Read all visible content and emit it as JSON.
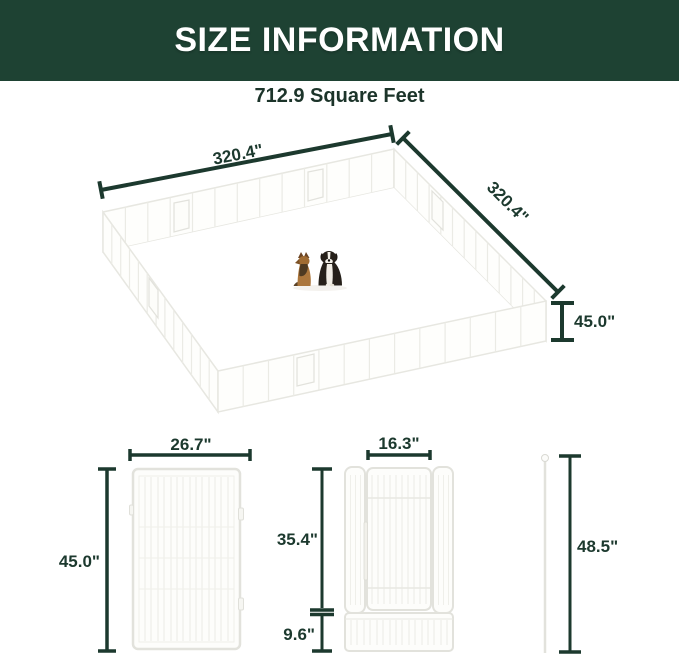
{
  "banner": {
    "title": "SIZE INFORMATION"
  },
  "area": {
    "label": "712.9 Square Feet"
  },
  "enclosure": {
    "width_label": "320.4\"",
    "depth_label": "320.4\"",
    "height_label": "45.0\""
  },
  "panel": {
    "width_label": "26.7\"",
    "height_label": "45.0\""
  },
  "door_panel": {
    "door_width_label": "16.3\"",
    "upper_height_label": "35.4\"",
    "bottom_height_label": "9.6\""
  },
  "stake": {
    "height_label": "48.5\""
  },
  "icons": {
    "dogs": "two-sitting-dogs-illustration",
    "german_shepherd": "dog-german-shepherd-icon",
    "bernese": "dog-bernese-icon"
  },
  "colors": {
    "banner_green": "#1e4233",
    "dimension_green": "#1c392e",
    "fence_light_gray": "#e7e7e1"
  }
}
